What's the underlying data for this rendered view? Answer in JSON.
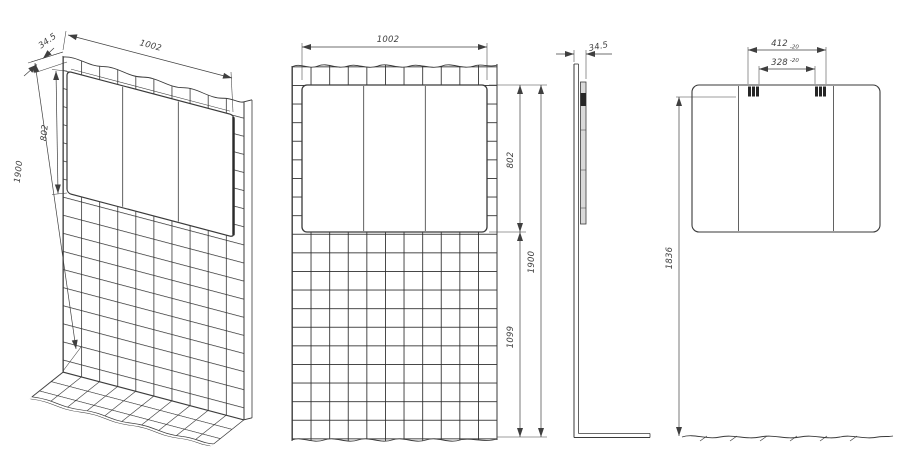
{
  "colors": {
    "background": "#ffffff",
    "outline": "#3a3a3a",
    "grout": "#2b2b2b",
    "dimension": "#3f3f3f",
    "mirror_fill": "#ffffff",
    "mirror_side_fill": "#d9d9d9",
    "bracket_fill": "#262626"
  },
  "views": {
    "isometric": {
      "dims": {
        "depth": "34.5",
        "width": "1002",
        "mirror_height": "802",
        "total_height": "1900"
      }
    },
    "front": {
      "dims": {
        "width": "1002",
        "mirror_height": "802",
        "total_height": "1900",
        "lower_height": "1099"
      }
    },
    "side": {
      "dims": {
        "depth": "34.5"
      }
    },
    "back": {
      "dims": {
        "bracket_outer": "412",
        "bracket_outer_tol": "-20",
        "bracket_inner": "328",
        "bracket_inner_tol": "-20",
        "mount_height": "1836"
      }
    }
  }
}
